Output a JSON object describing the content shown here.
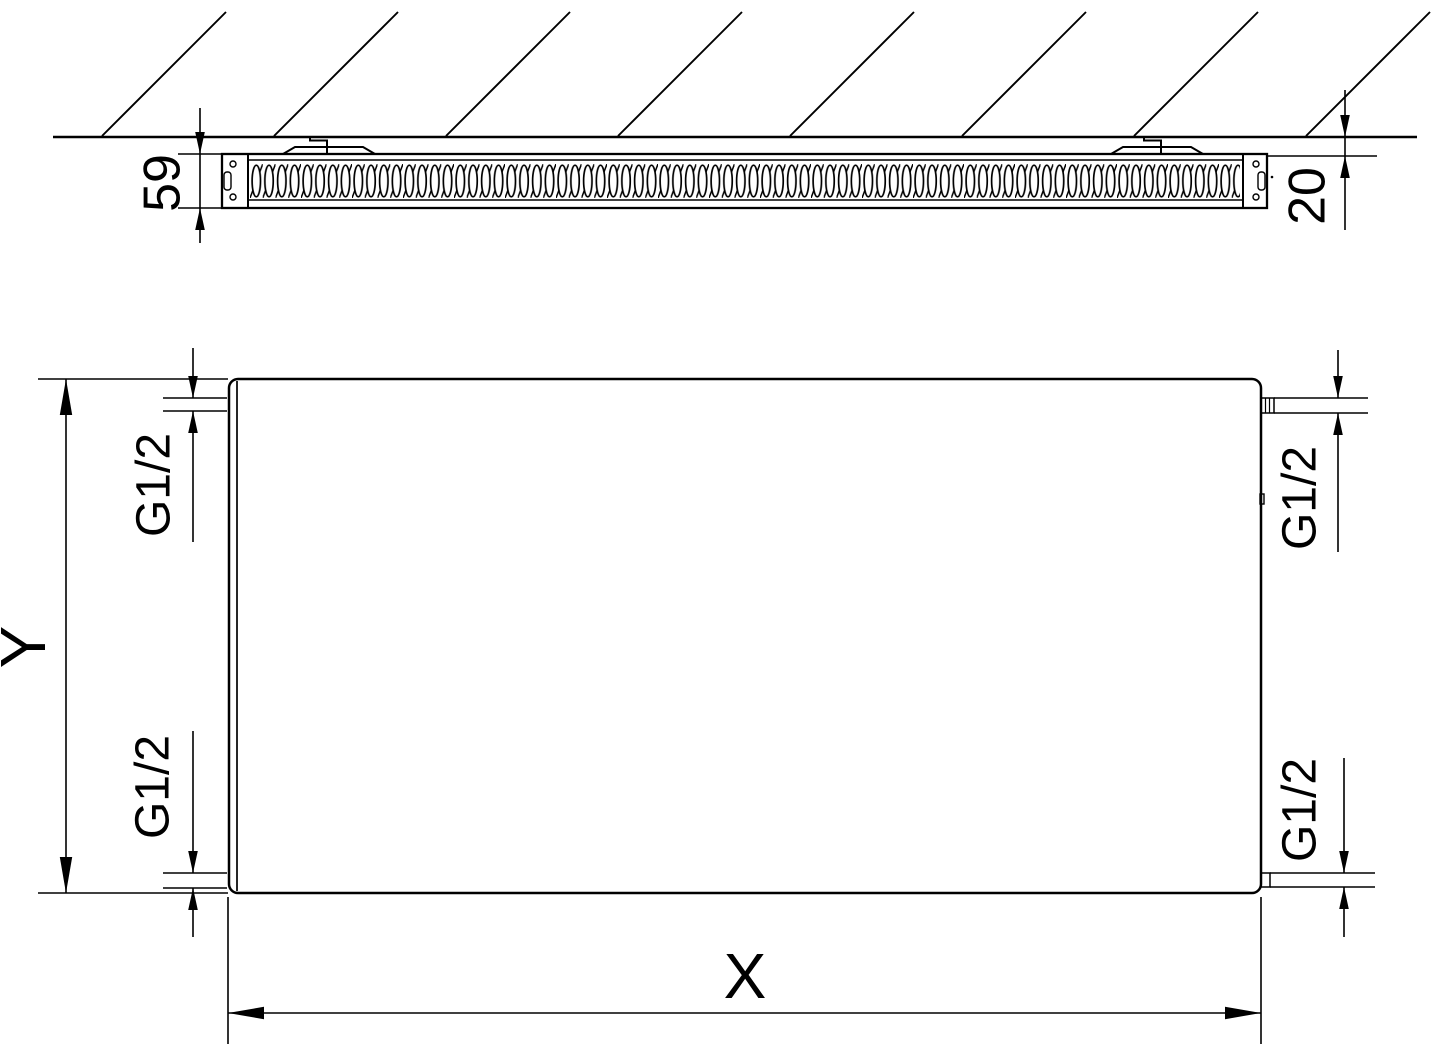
{
  "top_view": {
    "radiator_depth": "59",
    "wall_clearance": "20"
  },
  "front_view": {
    "width_label": "X",
    "height_label": "Y",
    "connections": {
      "top_left": "G1/2",
      "top_right": "G1/2",
      "bottom_left": "G1/2",
      "bottom_right": "G1/2"
    }
  },
  "colors": {
    "line": "#000000",
    "background": "#ffffff"
  }
}
